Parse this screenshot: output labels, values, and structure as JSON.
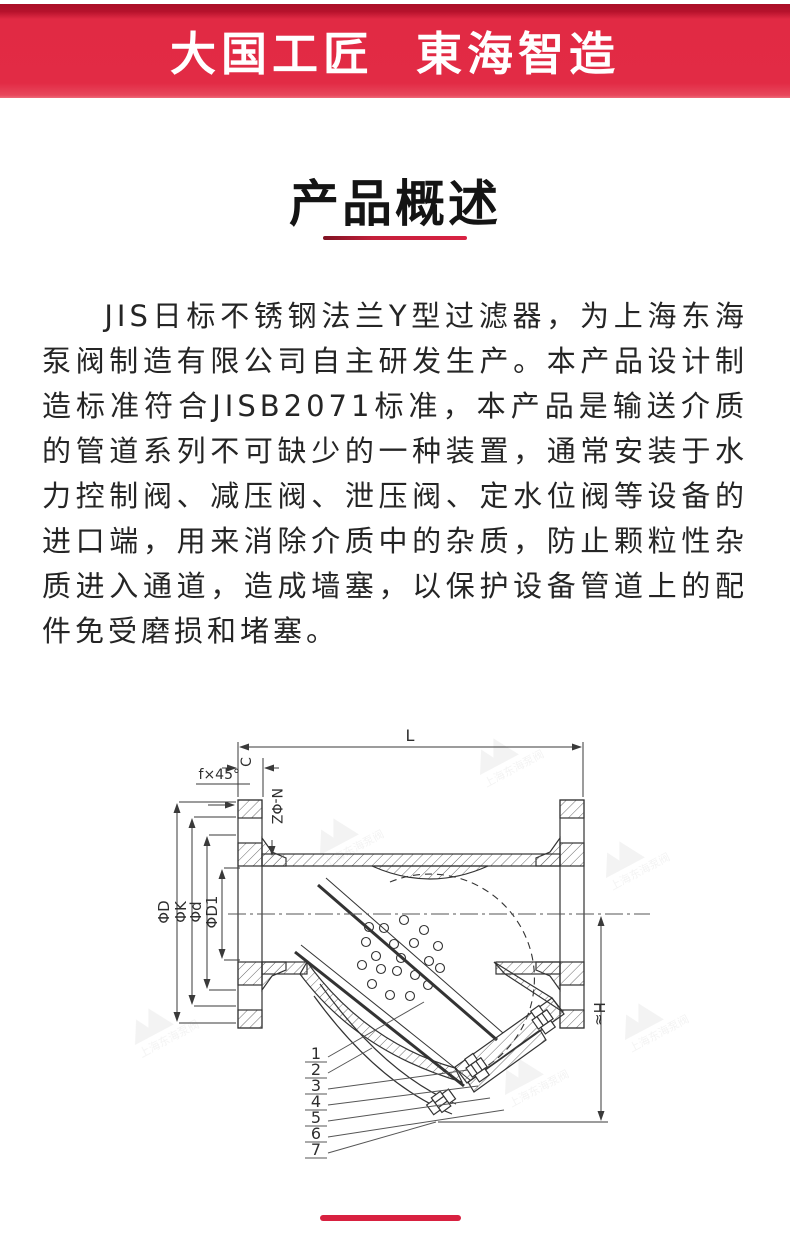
{
  "header": {
    "title": "大国工匠  東海智造",
    "bg_color": "#e22b45",
    "bg_dark_color": "#a90f27"
  },
  "section": {
    "title": "产品概述",
    "underline_color": "#c41f3a"
  },
  "paragraph": {
    "text": "JIS日标不锈钢法兰Y型过滤器，为上海东海泵阀制造有限公司自主研发生产。本产品设计制造标准符合JISB2071标准，本产品是输送介质的管道系列不可缺少的一种装置，通常安装于水力控制阀、减压阀、泄压阀、定水位阀等设备的进口端，用来消除介质中的杂质，防止颗粒性杂质进入通道，造成墙塞，以保护设备管道上的配件免受磨损和堵塞。"
  },
  "diagram": {
    "labels": {
      "length": "L",
      "flange_thickness": "C",
      "chamfer": "f×45°",
      "bolt_holes": "N-ΦZ",
      "flange_od": "ΦD",
      "bolt_circle": "ΦK",
      "raised_face": "Φd",
      "bore": "ΦD1",
      "height": "H≈"
    },
    "part_numbers": [
      "1",
      "2",
      "3",
      "4",
      "5",
      "6",
      "7"
    ],
    "watermark_text": "上海东海泵阀"
  },
  "footer": {
    "bar_color": "#d82140"
  }
}
